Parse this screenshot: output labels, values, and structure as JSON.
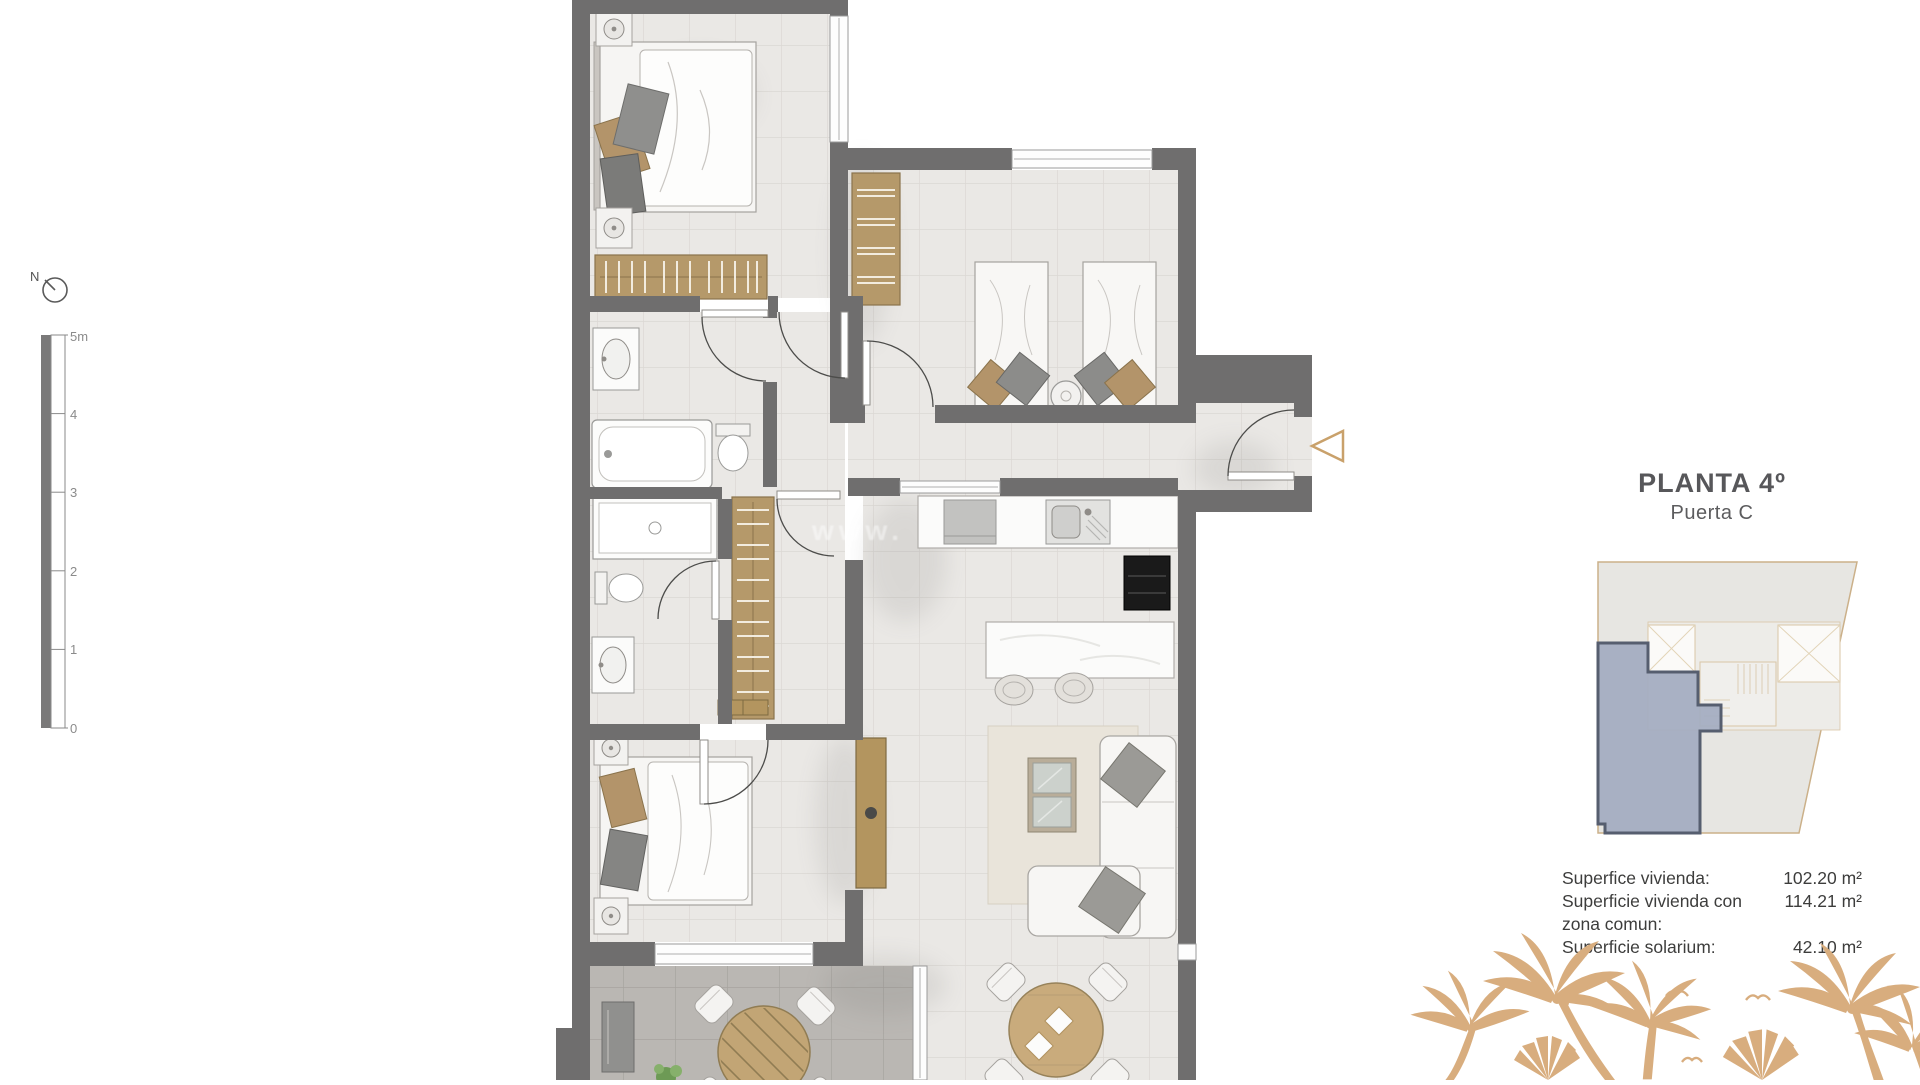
{
  "plan": {
    "header": {
      "title": "PLANTA 4º",
      "subtitle": "Puerta C"
    },
    "areas": {
      "rows": [
        {
          "label": "Superfice vivienda:",
          "value": "102.20 m²"
        },
        {
          "label": "Superficie vivienda con",
          "value": "114.21 m²"
        },
        {
          "label": "zona comun:",
          "value": ""
        },
        {
          "label": "Superficie solarium:",
          "value": "42.10 m²"
        }
      ]
    },
    "scale_bar": {
      "unit_labels": [
        "5m",
        "4",
        "3",
        "2",
        "1",
        "0"
      ]
    },
    "compass": {
      "label": "N"
    },
    "watermark": "www.",
    "rooms": [
      "bedroom-1",
      "bedroom-2",
      "bedroom-3",
      "bathroom-1",
      "bathroom-2",
      "hallway",
      "kitchen",
      "living-room",
      "dining-area",
      "terrace",
      "entry"
    ]
  },
  "colors": {
    "wall": "#6f6e6e",
    "floor": "#eae8e5",
    "terrace_floor": "#bab7b3",
    "wood": "#b5996a",
    "accent_tan": "#d8ad7e",
    "unit_highlight": "#a3abc0",
    "unit_outline": "#565e6f",
    "title_text": "#57575a",
    "body_text": "#3d3d3c"
  }
}
